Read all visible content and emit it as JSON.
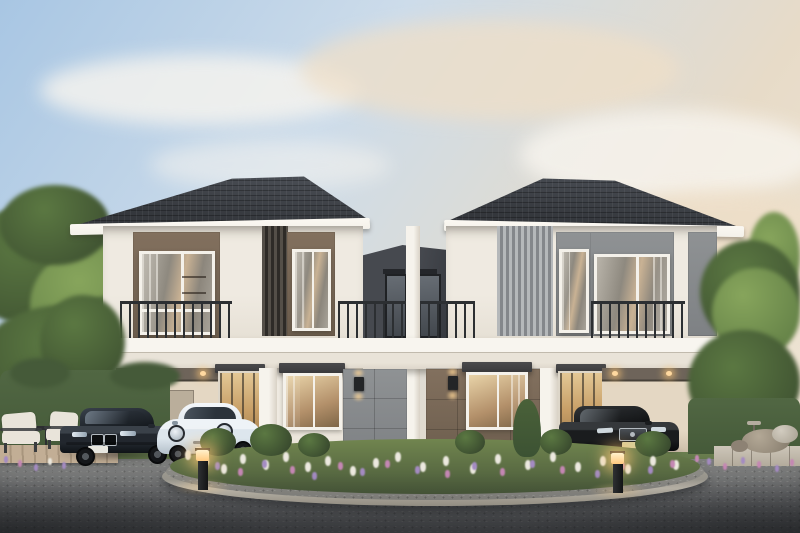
{
  "scene": {
    "description": "Dusk exterior rendering of a symmetrical pair of modern two-storey twin houses (duplex) with dark hip roofs, white facades, balconies, open carports, a landscaped flower island, asphalt driveway and three parked cars",
    "time_of_day": "dusk, warm low sun from the right",
    "left_house": {
      "accent": "warm brown facade panels",
      "features": [
        "hip roof in dark grey tile",
        "balcony with thin dark railing",
        "dark vertical louvre screen",
        "two upper windows with warm interiors",
        "open carport with recessed downlights",
        "glass entry door with canopy",
        "ground-floor window with dark awning",
        "grey panel wall with cube sconce"
      ]
    },
    "right_house": {
      "accent": "cool grey facade panels",
      "features": [
        "hip roof in dark grey tile",
        "balcony with thin dark railing",
        "light grey vertical louvre screen",
        "two upper windows",
        "brown panel wall with awning window and cube sconce",
        "glass entry door with canopy",
        "open carport with timber corner post",
        "garden visible through carport"
      ]
    },
    "connector": "recessed dark grey link block between the houses with two narrow windows and a central white pier",
    "vehicles": [
      {
        "name": "dark graphite luxury sedan",
        "body_color": "#22272e",
        "position": "left carport",
        "details": [
          "twin kidney grille",
          "white licence plate"
        ]
      },
      {
        "name": "pale blue compact electric hatchback",
        "body_color": "#dde6ed",
        "position": "in front of left entry",
        "details": [
          "round headlights",
          "white licence plate"
        ]
      },
      {
        "name": "black luxury sedan",
        "body_color": "#1a1c1e",
        "position": "right carport",
        "details": [
          "chrome grille with star emblem",
          "yellow licence plate"
        ]
      }
    ],
    "landscape": {
      "left": [
        "large leafy tree",
        "clipped hedge wall",
        "timber deck",
        "two cream lounge chairs",
        "small dark side table",
        "lavender cluster at deck edge"
      ],
      "center": [
        "oval flower island with green shrubs, conifer, white and purple-pink blooms",
        "gravel rim",
        "light concrete kerb",
        "grass strip at building base",
        "entry steps"
      ],
      "right": [
        "sunlit trees",
        "hedge",
        "stone patio",
        "boulder seats and pebble pouf",
        "small side table",
        "pink flower border"
      ]
    },
    "lighting": [
      "warm recessed carport downlights",
      "up-down cube wall sconces beside entries",
      "two glowing bollard path lights with pools of light"
    ],
    "counts": {
      "houses": 2,
      "cars": 3,
      "bollard_lights": 2,
      "lounge_chairs": 2,
      "balconies": 2,
      "wall_sconces": 2,
      "carports": 2
    }
  },
  "colors": {
    "sky_top": "#a8c6e3",
    "sky_mid": "#cddcea",
    "sky_warm": "#e7dbc8",
    "sky_horizon": "#f0e7d7",
    "cloud_white": "#f8f5ef",
    "cloud_warm": "#efdfc8",
    "roof_dark": "#34373c",
    "roof_light": "#4d5158",
    "fascia": "#f4f1ea",
    "wall": "#efeae1",
    "wall_shade": "#d9d2c6",
    "brown": "#82705e",
    "brown_dark": "#6d5e4e",
    "gray_accent": "#8f9294",
    "gray_panel": "#9b9ea0",
    "louver_dark_a": "#544f48",
    "louver_dark_b": "#2e2b27",
    "louver_light_a": "#b5b8ba",
    "louver_light_b": "#84878b",
    "connector": "#46494f",
    "connector_dark": "#35383e",
    "railing": "#2c2f32",
    "glass_cool_a": "#b9b4aa",
    "glass_cool_b": "#8e897f",
    "glass_warm": "#c9b294",
    "door_glass_a": "#e3c795",
    "door_glass_b": "#8f6f45",
    "awning": "#3a3a3c",
    "carport_ceiling": "#6e645a",
    "carport_wall": "#e4d7c3",
    "carport_wall_dark": "#c7b8a2",
    "asphalt_a": "#8a8b8d",
    "asphalt_b": "#737476",
    "asphalt_c": "#4e4f51",
    "curb": "#c6c0b3",
    "gravel": "#8b8a85",
    "grass": "#5f7347",
    "hedge": "#455a39",
    "tree": "#5b7842",
    "tree_bright": "#87a55c",
    "tree_deep": "#394a2e",
    "conifer": "#3c5233",
    "flower_white": "#ece9df",
    "flower_purple": "#a48bc2",
    "flower_pink": "#c587b4",
    "deck": "#b5a189",
    "cushion": "#e9e4da",
    "chair_frame": "#3a3c3e",
    "stone": "#a89c8c",
    "stone_light": "#c8c1b4",
    "wood_post": "#8d7150",
    "bmw_a": "#39414b",
    "bmw_b": "#22272e",
    "bmw_c": "#0f1317",
    "ora_a": "#eef3f7",
    "ora_b": "#dde6ed",
    "ora_c": "#b4c0ca",
    "merc_a": "#313437",
    "merc_b": "#1a1c1e",
    "merc_c": "#0a0b0c",
    "chrome": "#b3bac0",
    "plate": "#e8e7e0",
    "plate_yellow": "#d8ce9a",
    "glow": "#ffd9a0",
    "lamp": "#232527"
  }
}
